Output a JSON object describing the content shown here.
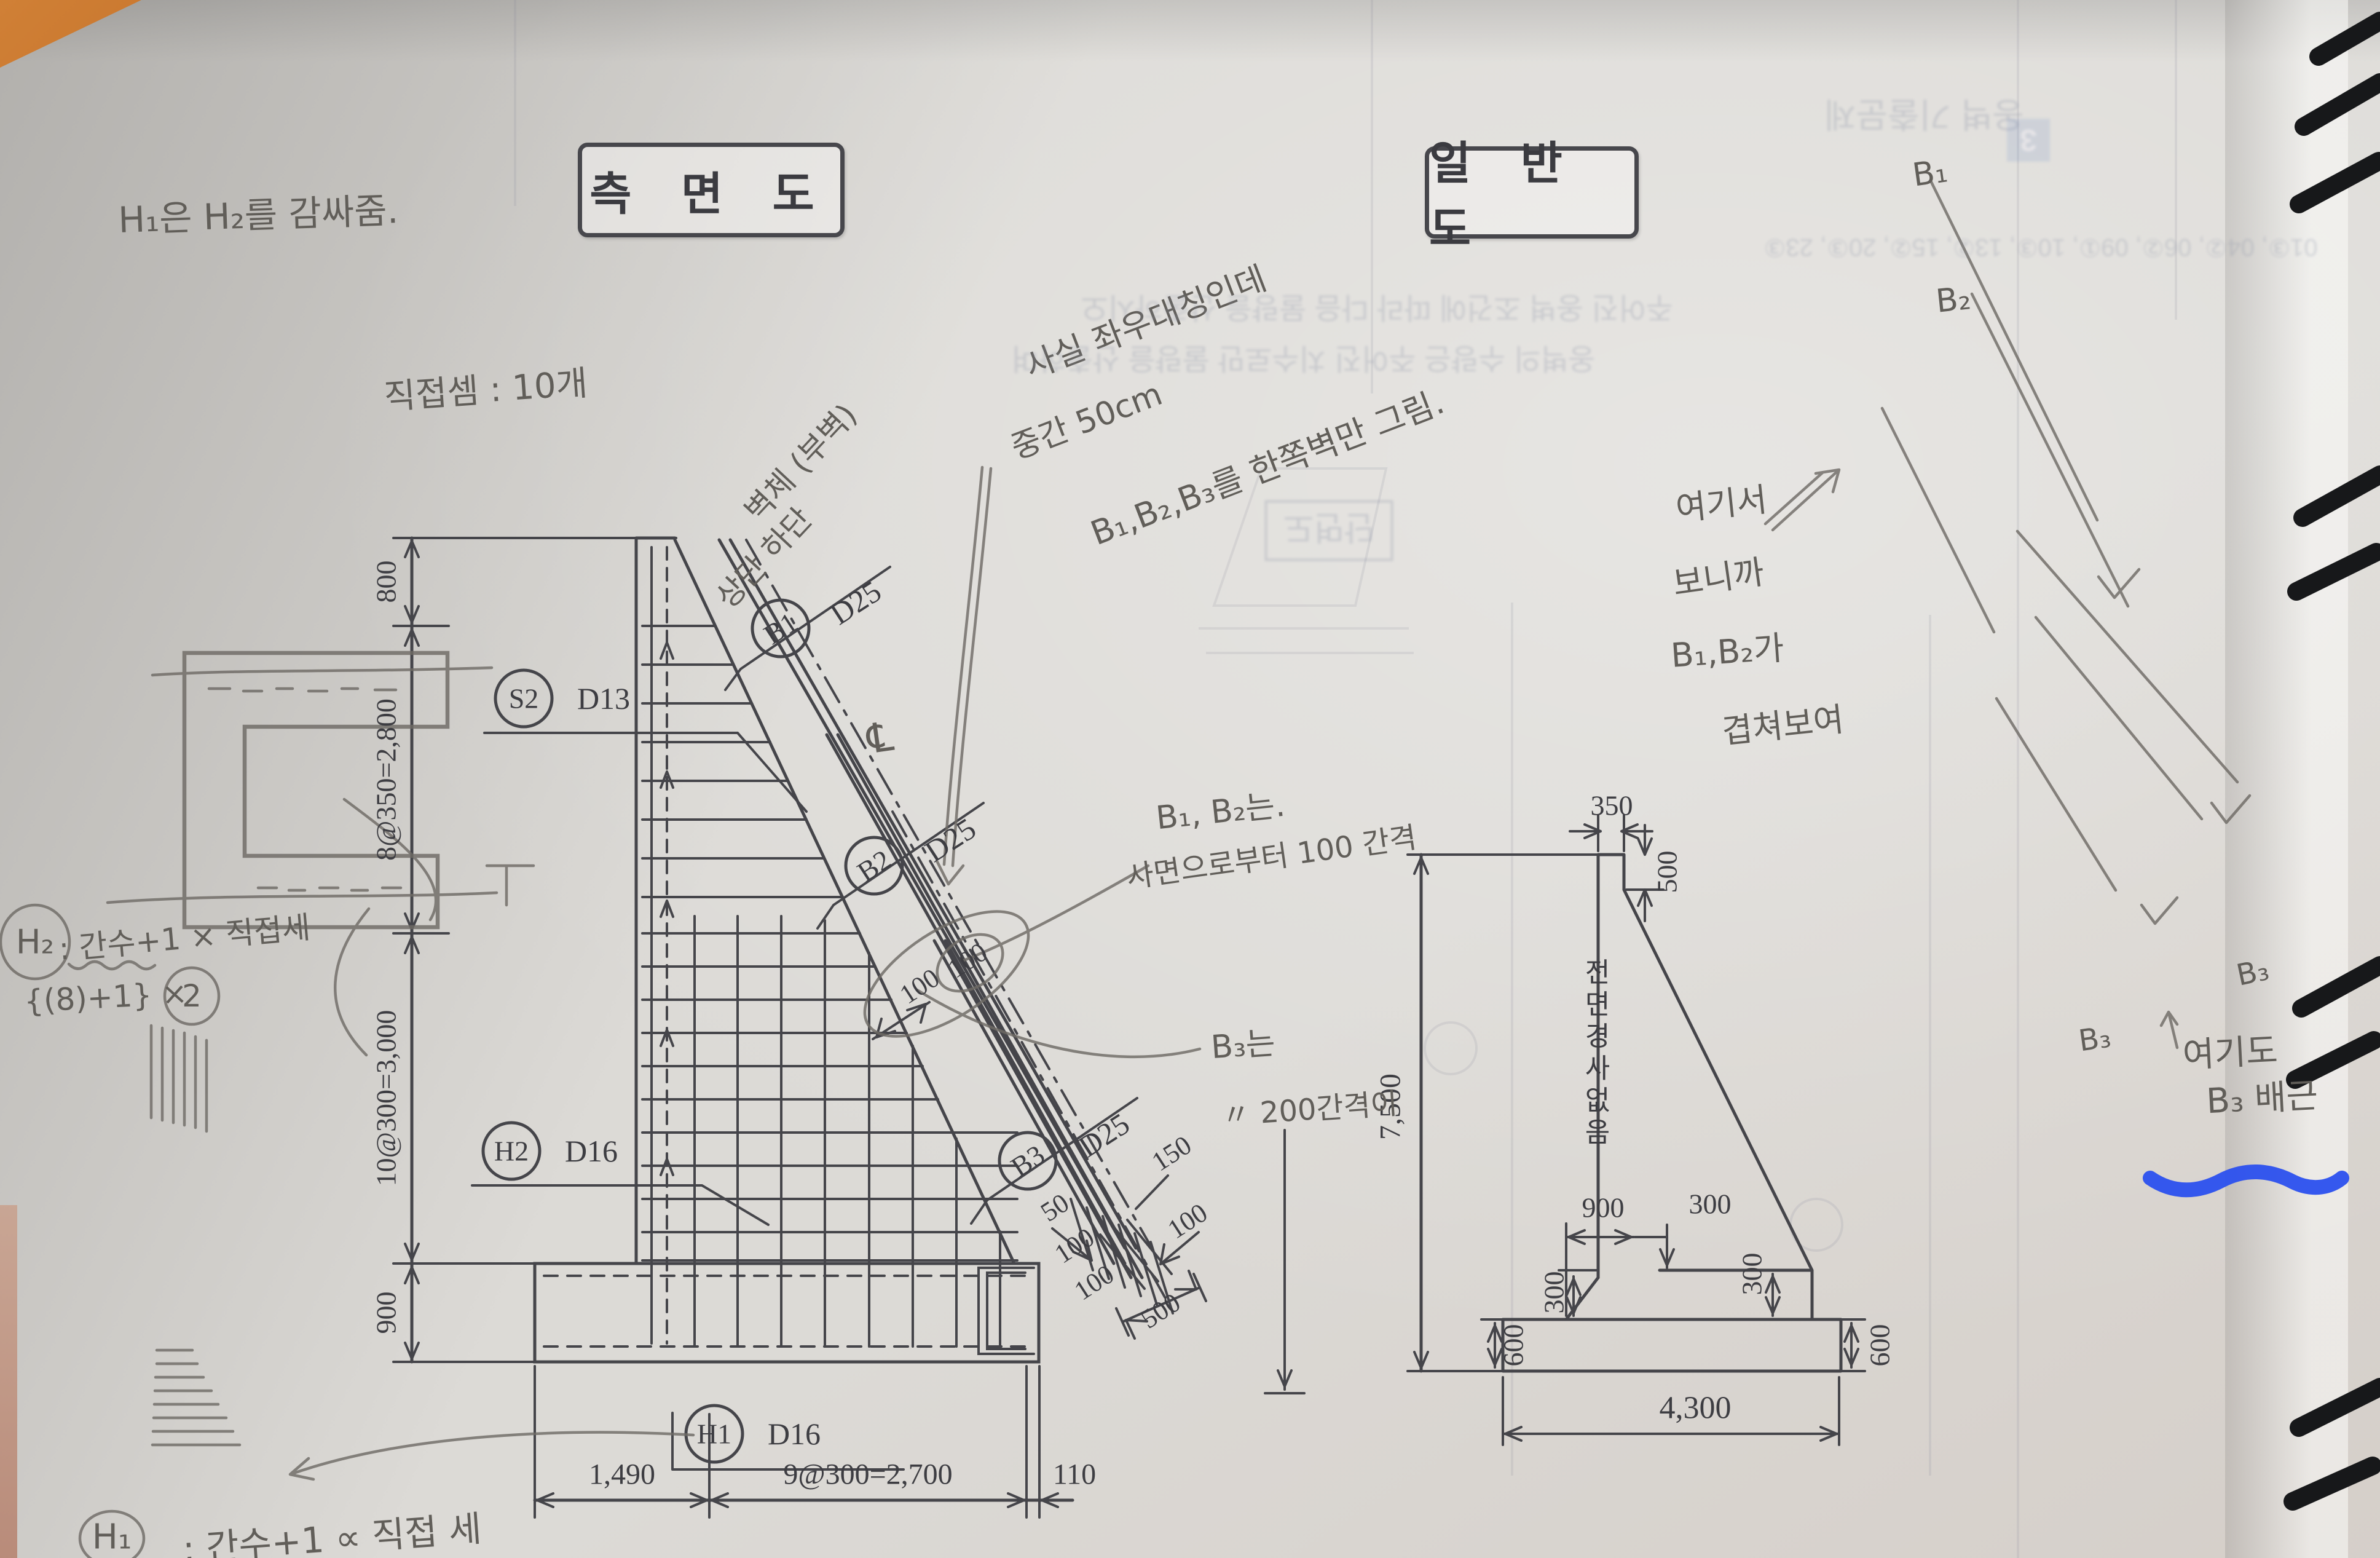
{
  "titles": {
    "side": "측 면 도",
    "general": "일 반 도"
  },
  "side_view": {
    "dims_left": [
      "800",
      "8@350=2,800",
      "10@300=3,000",
      "900"
    ],
    "dims_bottom": [
      "1,490",
      "9@300=2,700",
      "110"
    ],
    "dims_mid": [
      "100",
      "100"
    ],
    "dims_anchor": [
      "150",
      "50",
      "100",
      "100",
      "100",
      "500"
    ],
    "bars": {
      "s2": {
        "tag": "S2",
        "size": "D13"
      },
      "b1": {
        "tag": "B1",
        "size": "D25"
      },
      "b2": {
        "tag": "B2",
        "size": "D25"
      },
      "b3": {
        "tag": "B3",
        "size": "D25"
      },
      "h2": {
        "tag": "H2",
        "size": "D16"
      },
      "h1": {
        "tag": "H1",
        "size": "D16"
      }
    }
  },
  "general_view": {
    "dims": {
      "top_width": "350",
      "upper_right": "500",
      "height": "7,500",
      "toe": "900",
      "mid": "300",
      "heel": "300",
      "left_step": "300",
      "left_thk": "600",
      "right_thk": "600",
      "base_width": "4,300"
    },
    "front_note": "전면경사없음"
  },
  "handwriting": {
    "wrap_note": "H₁은 H₂를 감싸줌.",
    "count_note": "직접셈 : 10개",
    "wall_note1": "벽체 (부벽)",
    "wall_note2": "상단  하단",
    "centerline": "℄",
    "sym_note1": "사실 좌우대칭인데",
    "sym_note2": "중간 50cm",
    "sym_note3": "B₁,B₂,B₃를 한쪽벽만 그림.",
    "b12_note1": "B₁, B₂는.",
    "b12_note2": "사면으로부터 100 간격",
    "b3_note1": "B₃는",
    "b3_note2": "〃 200간격이",
    "view_note1": "여기서",
    "view_note2": "보니까",
    "view_note3": "B₁,B₂가",
    "view_note4": "겹쳐보여",
    "tr_b1": "B₁",
    "tr_b2": "B₂",
    "br_b3a": "B₃",
    "br_b3b": "B₃",
    "here_note1": "여기도",
    "here_note2": "B₃ 배근",
    "h2_head": "H₂",
    "h2_formula1": ": 간수+1 × 직접세",
    "h2_formula2": "{(8)+1} ×",
    "h2_circled": "2",
    "h1_head": "H₁",
    "h1_formula": ": 간수+1 ∝ 직접 세"
  },
  "bleedthrough": {
    "title": "옹벽 기출문제",
    "badge": "3",
    "line1": "주어진 옹벽 조건에 따라 다음 물량을 산출하시오",
    "line2": "옹벽의 수량은 주어진 치수로만 물량을 산출하며",
    "codes": "01③, 04②, 06②, 09①, 10③, 13②, 15②, 20③, 23③",
    "box": "단면도"
  },
  "colors": {
    "print": "#3d3d42",
    "pencil": "#6f6b66",
    "blue_pen": "#2b50ee",
    "paper": "#dcdad6"
  }
}
